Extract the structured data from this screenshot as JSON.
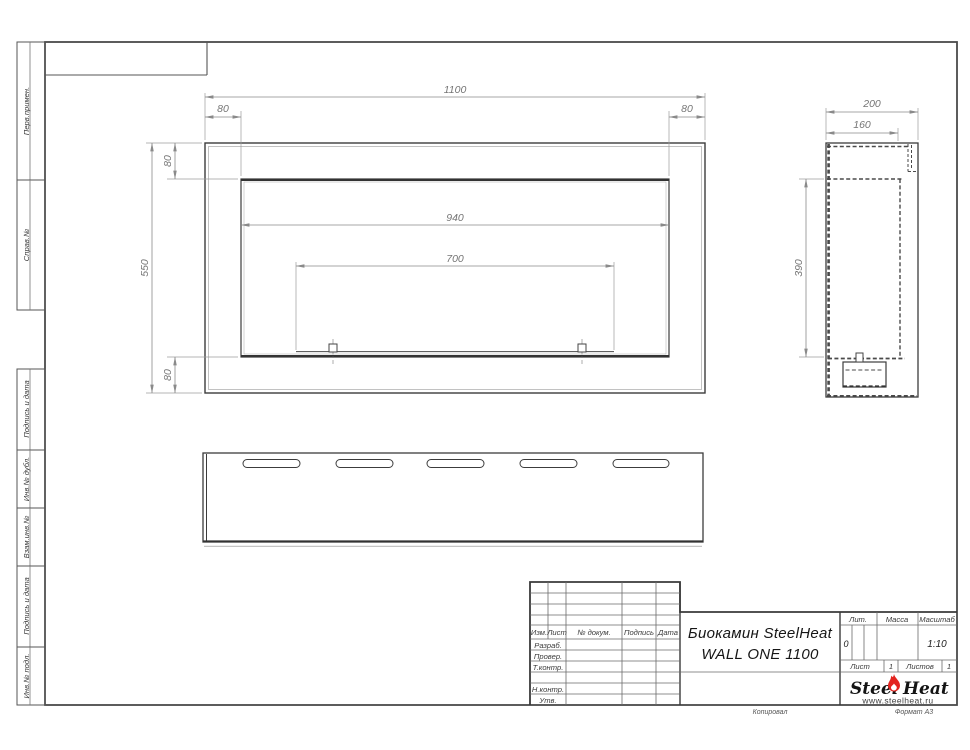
{
  "margin_blocks": [
    {
      "label": "Перв.примен."
    },
    {
      "label": "Справ.№"
    },
    {
      "label": "Подпись и дата"
    },
    {
      "label": "Инв.№ дубл."
    },
    {
      "label": "Взам.инв.№"
    },
    {
      "label": "Подпись и дата"
    },
    {
      "label": "Инв.№ подл."
    }
  ],
  "front_view": {
    "overall_width": "1100",
    "side_margin_left": "80",
    "side_margin_right": "80",
    "top_margin": "80",
    "overall_height": "550",
    "bottom_margin": "80",
    "opening_width": "940",
    "burner_width": "700"
  },
  "side_view": {
    "depth": "200",
    "inner_depth": "160",
    "opening_height": "390"
  },
  "title_block": {
    "header_cols": [
      "Изм.",
      "Лист",
      "№ докум.",
      "Подпись",
      "Дата"
    ],
    "staff_rows": [
      "Разраб.",
      "Провер.",
      "Т.контр.",
      "",
      "Н.контр.",
      "Утв."
    ],
    "doc_title_line1": "Биокамин SteelHeat",
    "doc_title_line2": "WALL ONE 1100",
    "lit_label": "Лит.",
    "lit_value": "0",
    "mass_label": "Масса",
    "scale_label": "Масштаб",
    "scale_value": "1:10",
    "sheet_label": "Лист",
    "sheet_value": "1",
    "sheets_label": "Листов",
    "sheets_value": "1",
    "logo_word1": "Steel",
    "logo_word2": "Heat",
    "logo_url": "www.steelheat.ru"
  },
  "footer": {
    "copy_label": "Копировал",
    "format_label": "Формат А3"
  },
  "colors": {
    "line_dark": "#3c3c3c",
    "line_dim": "#8a8a8a",
    "flame_red": "#e3241f"
  }
}
